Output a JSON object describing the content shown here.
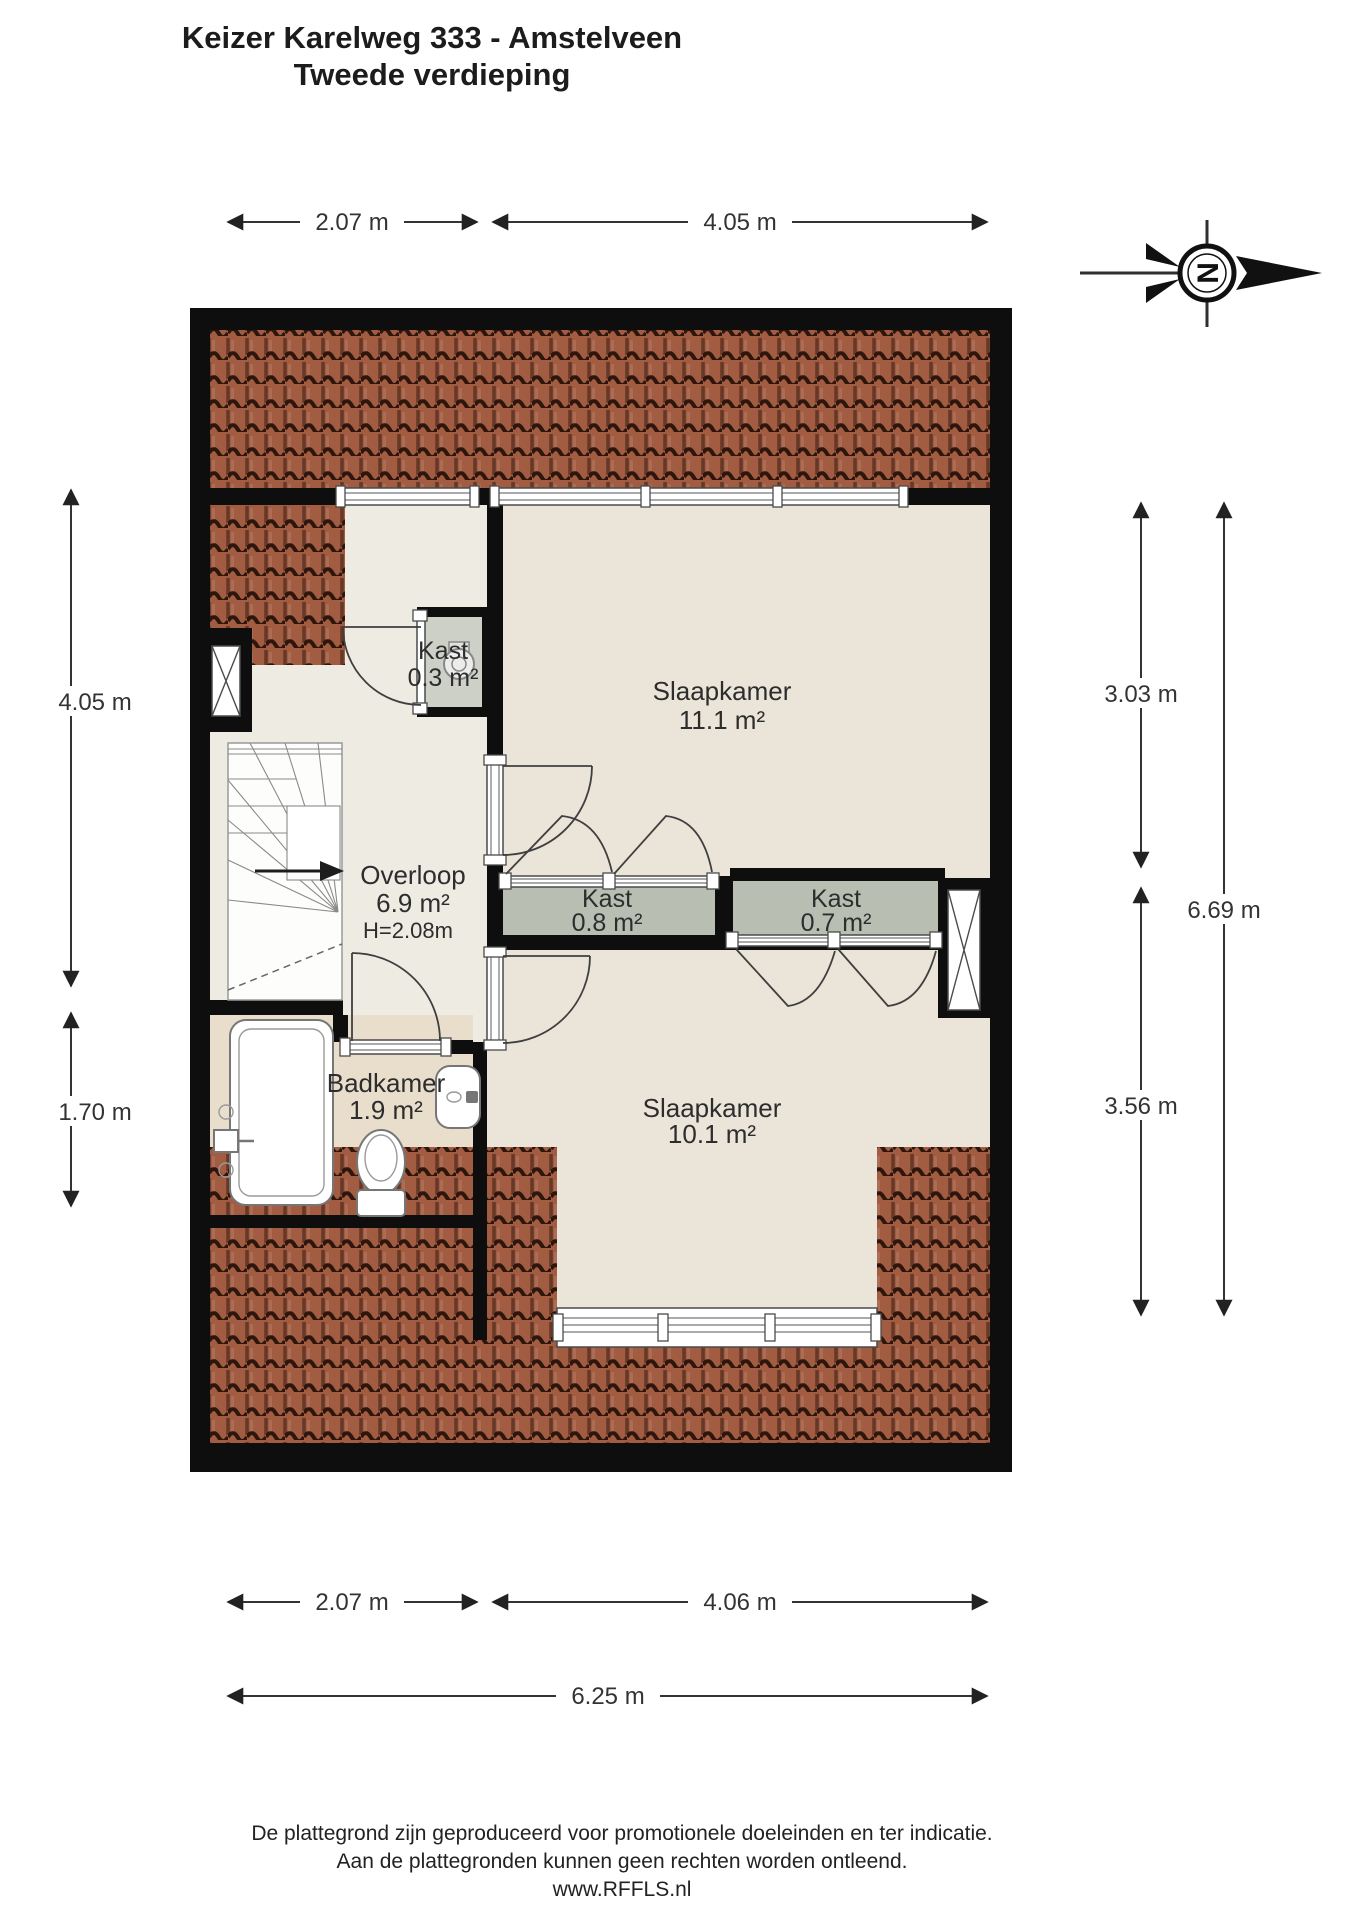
{
  "title": {
    "line1": "Keizer Karelweg 333 - Amstelveen",
    "line2": "Tweede verdieping"
  },
  "compass": {
    "north_letter": "N"
  },
  "dimensions": {
    "top": [
      "2.07 m",
      "4.05 m"
    ],
    "left": [
      "4.05 m",
      "1.70 m"
    ],
    "right": [
      "3.03 m",
      "3.56 m",
      "6.69 m"
    ],
    "bottom": [
      "2.07 m",
      "4.06 m",
      "6.25 m"
    ]
  },
  "rooms": {
    "kast_boven": {
      "name": "Kast",
      "area": "0.3 m²"
    },
    "slaapkamer_1": {
      "name": "Slaapkamer",
      "area": "11.1 m²"
    },
    "overloop": {
      "name": "Overloop",
      "area": "6.9 m²",
      "height": "H=2.08m"
    },
    "kast_links": {
      "name": "Kast",
      "area": "0.8 m²"
    },
    "kast_rechts": {
      "name": "Kast",
      "area": "0.7 m²"
    },
    "badkamer": {
      "name": "Badkamer",
      "area": "1.9 m²"
    },
    "slaapkamer_2": {
      "name": "Slaapkamer",
      "area": "10.1 m²"
    }
  },
  "footer": {
    "line1": "De plattegrond zijn geproduceerd voor promotionele doeleinden en ter indicatie.",
    "line2": "Aan de plattegronden kunnen geen rechten worden ontleend.",
    "line3": "www.RFFLS.nl"
  },
  "colors": {
    "wall": "#0e0e0e",
    "roof": "#a15c42",
    "roof-dark": "#2f160c",
    "floor": "#eae5d8",
    "floor-hall": "#edebe2",
    "floor-bath": "#e8decb",
    "closet": "#b9beb2",
    "closet-light": "#cdd0c6",
    "line": "#333333"
  }
}
